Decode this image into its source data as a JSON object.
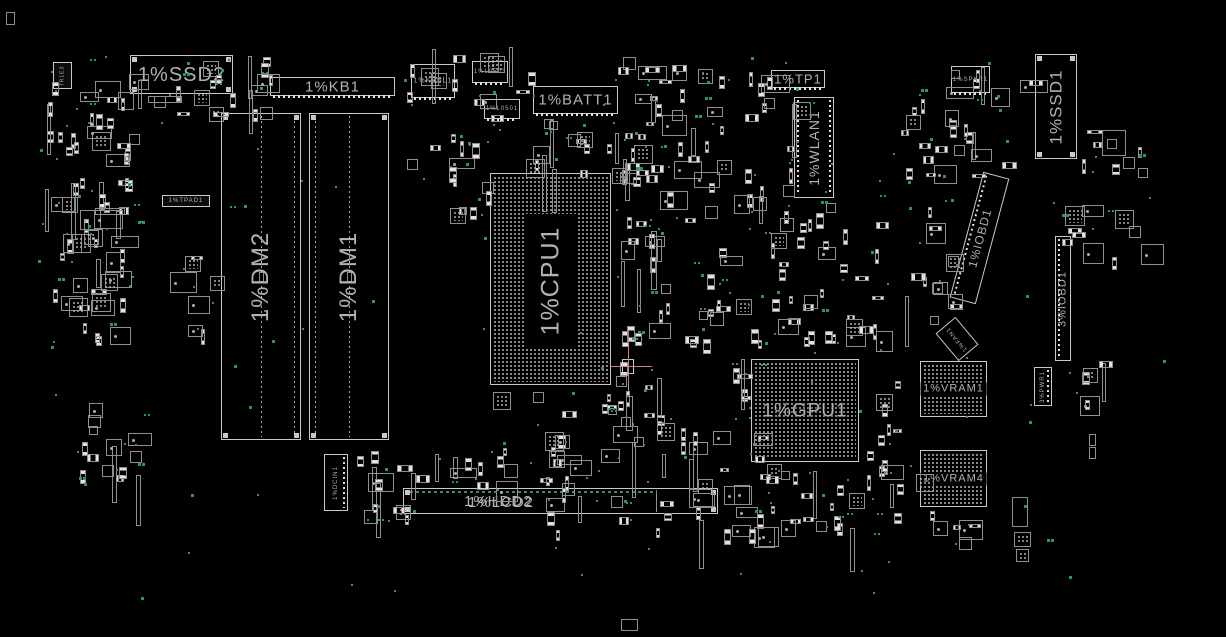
{
  "palette": {
    "background": "#000000",
    "outline": "#c9c9c9",
    "outline_dim": "#8f8f8f",
    "label": "#b2b2b2",
    "pad": "#e2e2e2",
    "dot": "#adadad",
    "teal": "#2f8e7d",
    "crosshair": "#c98484"
  },
  "components": [
    {
      "id": "ssd2-connector",
      "label": "1%SSD2",
      "type": "connector",
      "x": 130,
      "y": 55,
      "w": 103,
      "h": 39,
      "fs": 20,
      "rot": 0,
      "corners": true
    },
    {
      "id": "kb1-connector",
      "label": "1%KB1",
      "type": "connector",
      "x": 270,
      "y": 77,
      "w": 125,
      "h": 19,
      "fs": 15,
      "rot": 0,
      "pads": "bottom"
    },
    {
      "id": "kbbl1-connector",
      "label": "1%KBBL1",
      "type": "connector",
      "x": 411,
      "y": 64,
      "w": 44,
      "h": 34,
      "fs": 7,
      "rot": 0,
      "pads": "bottom"
    },
    {
      "id": "lcd503-connector",
      "label": "1%L0503",
      "type": "connector",
      "x": 472,
      "y": 61,
      "w": 36,
      "h": 22,
      "fs": 6,
      "rot": 0,
      "pads": "bottom"
    },
    {
      "id": "lcd501-connector",
      "label": "1%L0501",
      "type": "connector",
      "x": 484,
      "y": 99,
      "w": 36,
      "h": 20,
      "fs": 6,
      "rot": 0,
      "pads": "bottom"
    },
    {
      "id": "batt1-connector",
      "label": "1%BATT1",
      "type": "connector",
      "x": 533,
      "y": 86,
      "w": 85,
      "h": 28,
      "fs": 15,
      "rot": 0,
      "pads": "bottom"
    },
    {
      "id": "tp1-connector",
      "label": "1%TP1",
      "type": "connector",
      "x": 771,
      "y": 70,
      "w": 54,
      "h": 18,
      "fs": 13,
      "rot": 0,
      "pads": "bottom"
    },
    {
      "id": "wlan1-slot",
      "label": "1%WLAN1",
      "type": "connector",
      "x": 794,
      "y": 97,
      "w": 40,
      "h": 101,
      "fs": 14,
      "rot": -90,
      "pads": "sides"
    },
    {
      "id": "spkr1-connector",
      "label": "1%SPKR1",
      "type": "connector",
      "x": 951,
      "y": 66,
      "w": 39,
      "h": 27,
      "fs": 6,
      "rot": 0,
      "pads": "bottom"
    },
    {
      "id": "ssd1-connector",
      "label": "1%SSD1",
      "type": "connector",
      "x": 1035,
      "y": 54,
      "w": 42,
      "h": 105,
      "fs": 17,
      "rot": -90,
      "corners": true
    },
    {
      "id": "dimm2-slot",
      "label": "1%DM2",
      "type": "slot",
      "x": 221,
      "y": 113,
      "w": 80,
      "h": 327,
      "fs": 24,
      "rot": -90,
      "inner": "right"
    },
    {
      "id": "dimm1-slot",
      "label": "1%DM1",
      "type": "slot",
      "x": 309,
      "y": 113,
      "w": 80,
      "h": 327,
      "fs": 24,
      "rot": -90,
      "inner": "left"
    },
    {
      "id": "cpu1-bga",
      "label": "1%CPU1",
      "type": "bga",
      "x": 490,
      "y": 173,
      "w": 121,
      "h": 212,
      "fs": 25,
      "rot": -90,
      "pitch": 4,
      "centerBox": [
        34,
        40,
        52,
        134
      ]
    },
    {
      "id": "gpu1-bga",
      "label": "1%GPU1",
      "type": "bga",
      "x": 751,
      "y": 359,
      "w": 108,
      "h": 103,
      "fs": 19,
      "rot": 0,
      "pitch": 4
    },
    {
      "id": "vram1-bga",
      "label": "1%VRAM1",
      "type": "bga",
      "x": 920,
      "y": 361,
      "w": 67,
      "h": 56,
      "fs": 11,
      "rot": 0,
      "pitch": 4,
      "band": true
    },
    {
      "id": "vram4-bga",
      "label": "1%VRAM4",
      "type": "bga",
      "x": 920,
      "y": 450,
      "w": 67,
      "h": 57,
      "fs": 11,
      "rot": 0,
      "pitch": 4,
      "band": true
    },
    {
      "id": "iobd1-connector",
      "label": "1%IOBD1",
      "type": "connector",
      "x": 966,
      "y": 173,
      "w": 27,
      "h": 130,
      "fs": 12,
      "rot": -90,
      "tilt": 15,
      "pads": "left"
    },
    {
      "id": "iobd1-3-connector",
      "label": "3%IOBD1",
      "type": "connector",
      "x": 1055,
      "y": 236,
      "w": 16,
      "h": 125,
      "fs": 11,
      "rot": -90,
      "pads": "left"
    },
    {
      "id": "fan1-part",
      "label": "1%FAN1",
      "type": "plain",
      "x": 944,
      "y": 321,
      "w": 26,
      "h": 36,
      "fs": 6,
      "rot": -90,
      "tilt": -40
    },
    {
      "id": "pwr1-connector",
      "label": "3%PWR1",
      "type": "connector",
      "x": 1034,
      "y": 367,
      "w": 18,
      "h": 39,
      "fs": 6,
      "rot": -90,
      "pads": "right"
    },
    {
      "id": "dcin1-connector",
      "label": "1%DCIN1",
      "type": "connector",
      "x": 324,
      "y": 454,
      "w": 24,
      "h": 57,
      "fs": 6,
      "rot": -90,
      "pads": "right"
    },
    {
      "id": "hdd2-lcd2-connector",
      "labels": [
        "1%HDD2",
        "1%LCD2"
      ],
      "type": "connector",
      "x": 403,
      "y": 488,
      "w": 315,
      "h": 26,
      "fs": 15,
      "rot": 0,
      "corners": true,
      "tealTop": true,
      "divider": 252
    },
    {
      "id": "note-label",
      "label": "1%TPAD1",
      "type": "plain",
      "x": 162,
      "y": 195,
      "w": 48,
      "h": 12,
      "fs": 6,
      "rot": 0,
      "dark": true
    },
    {
      "id": "tr1e3-chip",
      "label": "TR1E3",
      "type": "plain",
      "x": 53,
      "y": 62,
      "w": 19,
      "h": 27,
      "fs": 5,
      "rot": -90,
      "dark": true
    }
  ],
  "clusters": [
    {
      "x": 45,
      "y": 55,
      "w": 90,
      "h": 285,
      "n": 68
    },
    {
      "x": 80,
      "y": 396,
      "w": 58,
      "h": 82,
      "n": 14
    },
    {
      "x": 138,
      "y": 58,
      "w": 125,
      "h": 55,
      "n": 15
    },
    {
      "x": 160,
      "y": 240,
      "w": 55,
      "h": 95,
      "n": 7
    },
    {
      "x": 405,
      "y": 46,
      "w": 132,
      "h": 118,
      "n": 22
    },
    {
      "x": 520,
      "y": 118,
      "w": 118,
      "h": 58,
      "n": 18
    },
    {
      "x": 612,
      "y": 55,
      "w": 182,
      "h": 62,
      "n": 26
    },
    {
      "x": 618,
      "y": 117,
      "w": 178,
      "h": 108,
      "n": 36
    },
    {
      "x": 618,
      "y": 228,
      "w": 135,
      "h": 118,
      "n": 28
    },
    {
      "x": 756,
      "y": 196,
      "w": 122,
      "h": 150,
      "n": 36
    },
    {
      "x": 900,
      "y": 95,
      "w": 105,
      "h": 80,
      "n": 20
    },
    {
      "x": 893,
      "y": 200,
      "w": 62,
      "h": 120,
      "n": 13
    },
    {
      "x": 1078,
      "y": 128,
      "w": 62,
      "h": 45,
      "n": 8
    },
    {
      "x": 1058,
      "y": 205,
      "w": 85,
      "h": 58,
      "n": 10
    },
    {
      "x": 1075,
      "y": 358,
      "w": 28,
      "h": 55,
      "n": 6
    },
    {
      "x": 478,
      "y": 390,
      "w": 182,
      "h": 42,
      "n": 10
    },
    {
      "x": 545,
      "y": 425,
      "w": 228,
      "h": 106,
      "n": 46
    },
    {
      "x": 350,
      "y": 446,
      "w": 58,
      "h": 80,
      "n": 12
    },
    {
      "x": 405,
      "y": 440,
      "w": 158,
      "h": 46,
      "n": 16
    },
    {
      "x": 733,
      "y": 350,
      "w": 22,
      "h": 115,
      "n": 6
    },
    {
      "x": 745,
      "y": 470,
      "w": 172,
      "h": 62,
      "n": 24
    },
    {
      "x": 862,
      "y": 378,
      "w": 58,
      "h": 92,
      "n": 10
    },
    {
      "x": 946,
      "y": 58,
      "w": 88,
      "h": 38,
      "n": 8
    },
    {
      "x": 240,
      "y": 55,
      "w": 35,
      "h": 30,
      "n": 5
    },
    {
      "x": 610,
      "y": 352,
      "w": 52,
      "h": 72,
      "n": 8
    },
    {
      "x": 448,
      "y": 155,
      "w": 40,
      "h": 60,
      "n": 7
    },
    {
      "x": 918,
      "y": 510,
      "w": 75,
      "h": 30,
      "n": 6
    }
  ],
  "extra_parts": [
    {
      "x": 6,
      "y": 12,
      "w": 9,
      "h": 13
    },
    {
      "x": 621,
      "y": 619,
      "w": 17,
      "h": 12
    },
    {
      "x": 1012,
      "y": 497,
      "w": 16,
      "h": 30
    },
    {
      "x": 1014,
      "y": 532,
      "w": 17,
      "h": 15,
      "qfn": true
    },
    {
      "x": 1016,
      "y": 549,
      "w": 13,
      "h": 13,
      "qfn": true
    },
    {
      "x": 1089,
      "y": 434,
      "w": 7,
      "h": 12
    },
    {
      "x": 1089,
      "y": 447,
      "w": 7,
      "h": 12
    },
    {
      "x": 1102,
      "y": 130,
      "w": 24,
      "h": 26
    },
    {
      "x": 95,
      "y": 208,
      "w": 30,
      "h": 7
    },
    {
      "x": 148,
      "y": 96,
      "w": 34,
      "h": 7
    },
    {
      "x": 651,
      "y": 231,
      "w": 6,
      "h": 59
    },
    {
      "x": 626,
      "y": 396,
      "w": 7,
      "h": 35
    }
  ],
  "crosshair": {
    "x": 628,
    "y": 366,
    "v_from": 337,
    "v_to": 392,
    "h_from": 610,
    "h_to": 652,
    "box": [
      622,
      359,
      12,
      15
    ]
  },
  "dots": {
    "global_count": 70,
    "region": [
      40,
      40,
      1140,
      560
    ]
  }
}
